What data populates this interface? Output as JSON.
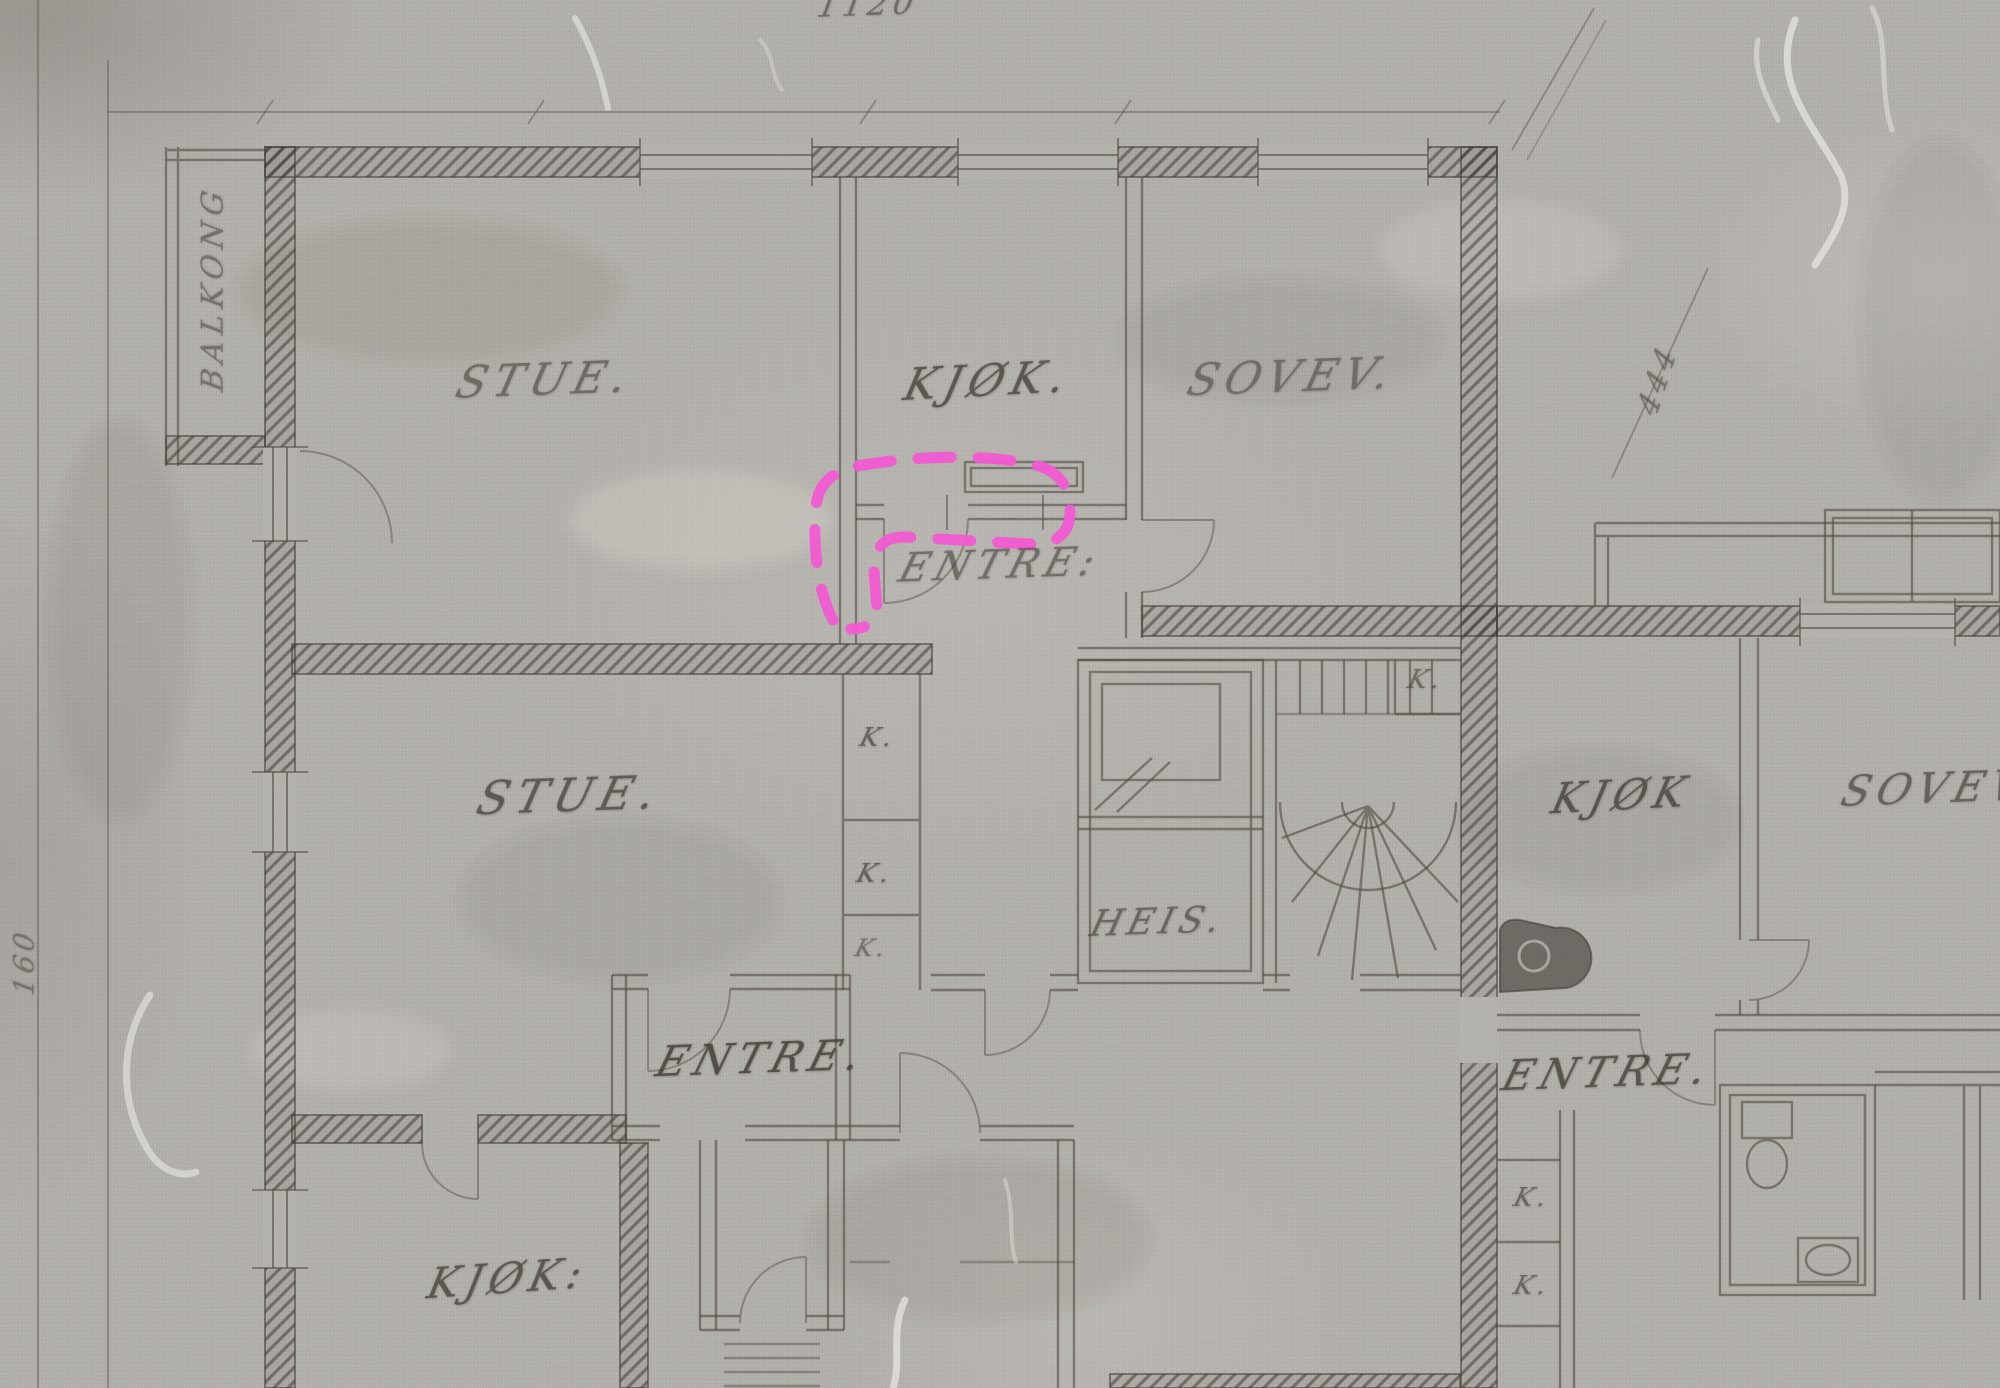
{
  "document": {
    "kind": "scanned architectural floor plan, pencil on grey paper",
    "language": "Norwegian"
  },
  "colors": {
    "paper": "#b7b5b0",
    "pencil": "#45403a",
    "annotation_pink": "#f25ad2"
  },
  "annotation": {
    "shape": "hand-drawn dashed loop with tail",
    "style": "dashed",
    "color": "#f25ad2",
    "target": "entre doorway / kitchen wall corner"
  },
  "labels": {
    "balkong": "BALKONG",
    "stue_top": "STUE.",
    "kjok_top": "KJØK.",
    "sovev_top": "SOVEV.",
    "entre_top": "ENTRE:",
    "stue_left": "STUE.",
    "k_closet_1": "K.",
    "k_closet_2": "K.",
    "k_closet_3": "K.",
    "heis": "HEIS.",
    "k_stairs": "K.",
    "kjok_right": "KJØK",
    "sovev_right": "SOVEV",
    "entre_left": "ENTRE.",
    "entre_right": "ENTRE.",
    "kjok_bottom": "KJØK:",
    "k_right_1": "K.",
    "k_right_2": "K."
  },
  "dimensions": {
    "top": "1120",
    "right_diagonal": "444",
    "left_vertical": "160"
  }
}
